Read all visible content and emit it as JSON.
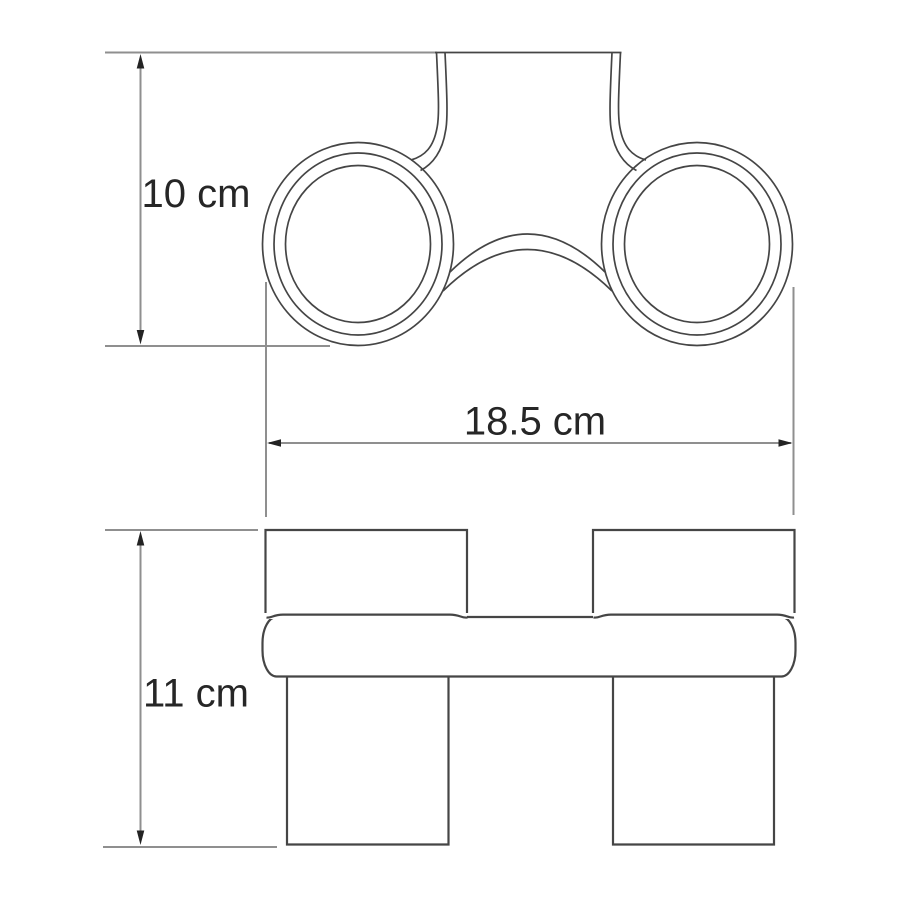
{
  "colors": {
    "background": "#ffffff",
    "object_line": "#454545",
    "dimension_line": "#8f8f8f",
    "arrowhead": "#232323",
    "label_text": "#262626"
  },
  "drawing": {
    "dimensions": {
      "depth": {
        "label": "10 cm"
      },
      "width": {
        "label": "18.5 cm"
      },
      "height": {
        "label": "11 cm"
      }
    }
  }
}
